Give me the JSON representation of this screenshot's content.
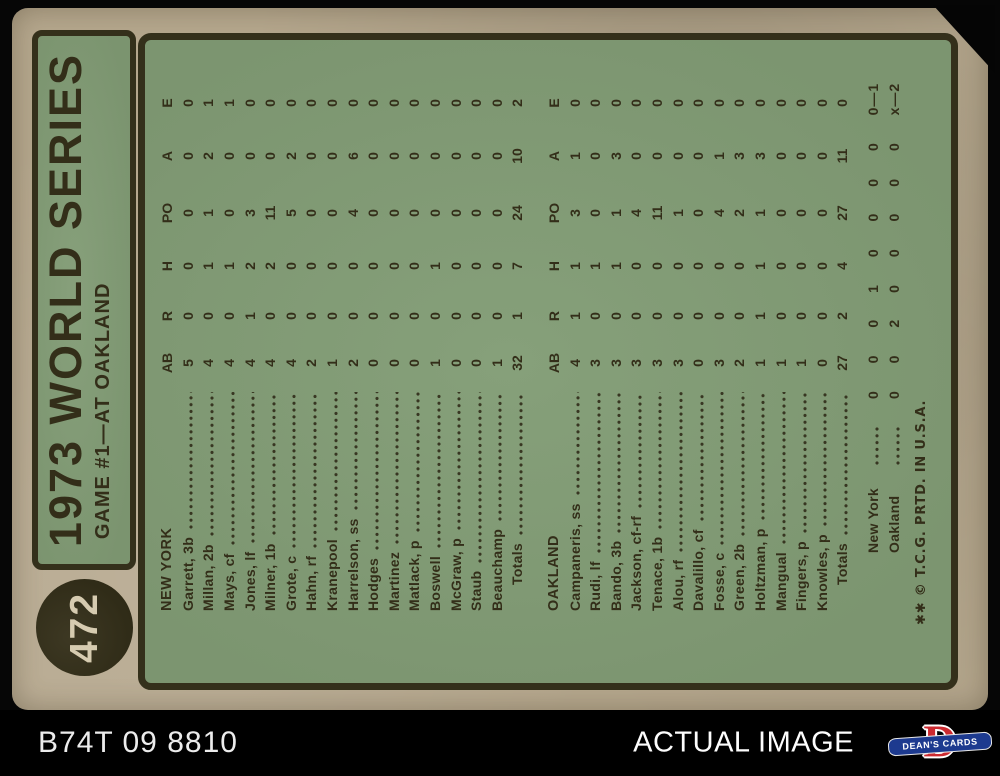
{
  "card": {
    "number": "472",
    "title": "1973 WORLD SERIES",
    "subtitle": "GAME #1—AT OAKLAND",
    "copyright": "✱✱ © T.C.G. PRTD. IN U.S.A.",
    "box_score": {
      "columns": [
        "AB",
        "R",
        "H",
        "PO",
        "A",
        "E"
      ],
      "teams": [
        {
          "name": "NEW YORK",
          "players": [
            {
              "name": "Garrett, 3b",
              "stats": [
                5,
                0,
                0,
                0,
                0,
                0
              ]
            },
            {
              "name": "Millan, 2b",
              "stats": [
                4,
                0,
                1,
                1,
                2,
                1
              ]
            },
            {
              "name": "Mays, cf",
              "stats": [
                4,
                0,
                1,
                0,
                0,
                1
              ]
            },
            {
              "name": "Jones, lf",
              "stats": [
                4,
                1,
                2,
                3,
                0,
                0
              ]
            },
            {
              "name": "Milner, 1b",
              "stats": [
                4,
                0,
                2,
                11,
                0,
                0
              ]
            },
            {
              "name": "Grote, c",
              "stats": [
                4,
                0,
                0,
                5,
                2,
                0
              ]
            },
            {
              "name": "Hahn, rf",
              "stats": [
                2,
                0,
                0,
                0,
                0,
                0
              ]
            },
            {
              "name": "Kranepool",
              "stats": [
                1,
                0,
                0,
                0,
                0,
                0
              ]
            },
            {
              "name": "Harrelson, ss",
              "stats": [
                2,
                0,
                0,
                4,
                6,
                0
              ]
            },
            {
              "name": "Hodges",
              "stats": [
                0,
                0,
                0,
                0,
                0,
                0
              ]
            },
            {
              "name": "Martinez",
              "stats": [
                0,
                0,
                0,
                0,
                0,
                0
              ]
            },
            {
              "name": "Matlack, p",
              "stats": [
                0,
                0,
                0,
                0,
                0,
                0
              ]
            },
            {
              "name": "Boswell",
              "stats": [
                1,
                0,
                1,
                0,
                0,
                0
              ]
            },
            {
              "name": "McGraw, p",
              "stats": [
                0,
                0,
                0,
                0,
                0,
                0
              ]
            },
            {
              "name": "Staub",
              "stats": [
                0,
                0,
                0,
                0,
                0,
                0
              ]
            },
            {
              "name": "Beauchamp",
              "stats": [
                1,
                0,
                0,
                0,
                0,
                0
              ]
            }
          ],
          "totals": {
            "label": "Totals",
            "stats": [
              32,
              1,
              7,
              24,
              10,
              2
            ]
          }
        },
        {
          "name": "OAKLAND",
          "players": [
            {
              "name": "Campaneris, ss",
              "stats": [
                4,
                1,
                1,
                3,
                1,
                0
              ]
            },
            {
              "name": "Rudi, lf",
              "stats": [
                3,
                0,
                1,
                0,
                0,
                0
              ]
            },
            {
              "name": "Bando, 3b",
              "stats": [
                3,
                0,
                1,
                1,
                3,
                0
              ]
            },
            {
              "name": "Jackson, cf-rf",
              "stats": [
                3,
                0,
                0,
                4,
                0,
                0
              ]
            },
            {
              "name": "Tenace, 1b",
              "stats": [
                3,
                0,
                0,
                11,
                0,
                0
              ]
            },
            {
              "name": "Alou, rf",
              "stats": [
                3,
                0,
                0,
                1,
                0,
                0
              ]
            },
            {
              "name": "Davalillo, cf",
              "stats": [
                0,
                0,
                0,
                0,
                0,
                0
              ]
            },
            {
              "name": "Fosse, c",
              "stats": [
                3,
                0,
                0,
                4,
                1,
                0
              ]
            },
            {
              "name": "Green, 2b",
              "stats": [
                2,
                0,
                0,
                2,
                3,
                0
              ]
            },
            {
              "name": "Holtzman, p",
              "stats": [
                1,
                1,
                1,
                1,
                3,
                0
              ]
            },
            {
              "name": "Mangual",
              "stats": [
                1,
                0,
                0,
                0,
                0,
                0
              ]
            },
            {
              "name": "Fingers, p",
              "stats": [
                1,
                0,
                0,
                0,
                0,
                0
              ]
            },
            {
              "name": "Knowles, p",
              "stats": [
                0,
                0,
                0,
                0,
                0,
                0
              ]
            }
          ],
          "totals": {
            "label": "Totals",
            "stats": [
              27,
              2,
              4,
              27,
              11,
              0
            ]
          }
        }
      ]
    },
    "line_score": [
      {
        "team": "New York",
        "groups": [
          "0 0 0",
          "1 0 0",
          "0 0 0"
        ],
        "result": "1"
      },
      {
        "team": "Oakland",
        "groups": [
          "0 0 2",
          "0 0 0",
          "0 0 x"
        ],
        "result": "2"
      }
    ]
  },
  "footer": {
    "left_text": "B74T 09 8810",
    "right_text": "ACTUAL IMAGE",
    "logo_text": "DEAN'S CARDS",
    "logo_d": "D"
  },
  "colors": {
    "card_tan": "#b5a78d",
    "frame_dark": "#34301b",
    "panel_green": "#7f9873",
    "ink_dark": "#332e19",
    "number_cream": "#d6cbb0",
    "bar_background": "#000000",
    "bar_text": "#ececec",
    "logo_red": "#cc2a30",
    "logo_blue": "#1d3a8f"
  }
}
